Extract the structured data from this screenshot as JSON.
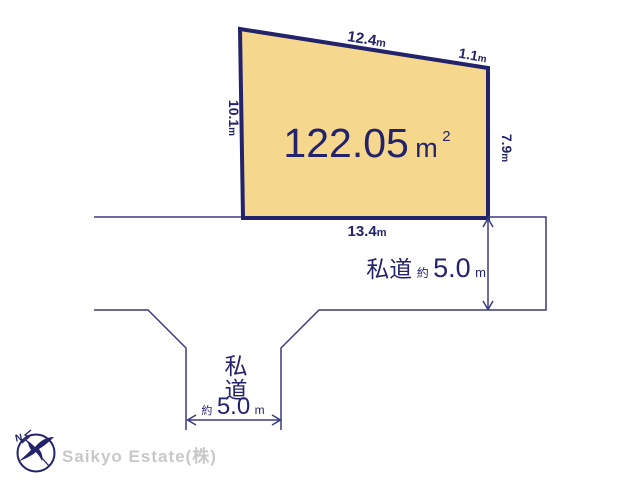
{
  "colors": {
    "plot_fill": "#F6D78E",
    "navy": "#23236B",
    "thin_line": "#3A3A80",
    "logo_text_gray": "#C8C8C8"
  },
  "plot": {
    "area_value": "122.05",
    "area_unit": "m",
    "area_unit_sup": "2"
  },
  "dimensions": {
    "top": {
      "value": "12.4",
      "unit": "m"
    },
    "top_right": {
      "value": "1.1",
      "unit": "m"
    },
    "left": {
      "value": "10.1",
      "unit": "m"
    },
    "right": {
      "value": "7.9",
      "unit": "m"
    },
    "bottom": {
      "value": "13.4",
      "unit": "m"
    }
  },
  "roads": {
    "right_road": {
      "kanji": "私道",
      "approx": "約",
      "value": "5.0",
      "unit": "m"
    },
    "bottom_road": {
      "kanji_1": "私",
      "kanji_2": "道",
      "approx": "約",
      "value": "5.0",
      "unit": "m"
    }
  },
  "branding": {
    "company": "Saikyo Estate(株)",
    "compass_n": "N"
  }
}
